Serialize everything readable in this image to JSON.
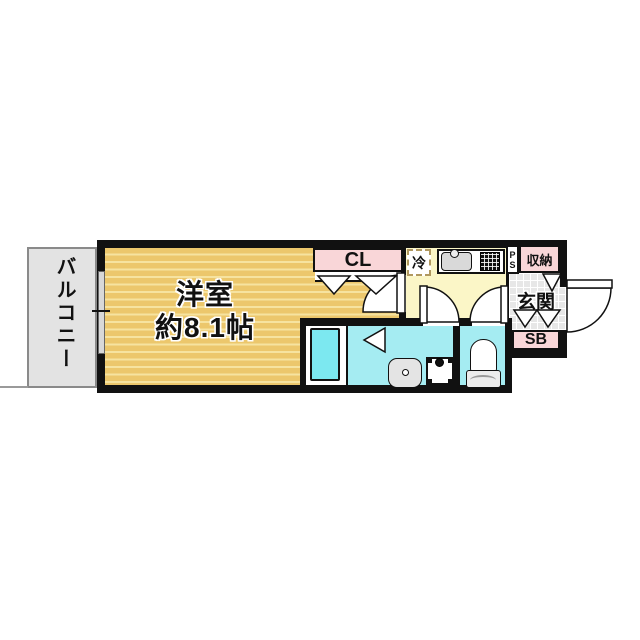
{
  "plan": {
    "balcony": {
      "label": "バルコニー"
    },
    "main_room": {
      "name": "洋室",
      "size": "約8.1帖"
    },
    "closet": {
      "label": "CL"
    },
    "refrigerator": {
      "label": "冷"
    },
    "pipe_space": {
      "line1": "P",
      "line2": "S"
    },
    "storage": {
      "label": "収納"
    },
    "entrance": {
      "label": "玄関"
    },
    "shoe_box": {
      "label": "SB"
    },
    "fixtures": {
      "bathtub": "unit bath tub",
      "washbasin": "wash basin",
      "washing_machine_pan": "washing machine pan",
      "toilet": "toilet",
      "kitchen_sink": "kitchen sink",
      "stove": "two-burner stove",
      "doors": "hinged door swing arcs, folding-door triangles, sliding window to balcony"
    },
    "colors": {
      "wall": "#111111",
      "wood": "#ecc76c",
      "wood_stripe": "#f6e3a0",
      "pink": "#f9d6d8",
      "kitchen_yellow": "#fbf6c7",
      "water_cyan": "#a5ecf2",
      "tub_cyan": "#7ce8f0",
      "balcony_gray": "#e3e3e3",
      "tile_gray": "#e7e7e7",
      "fixture_gray": "#d9d9d9"
    }
  }
}
